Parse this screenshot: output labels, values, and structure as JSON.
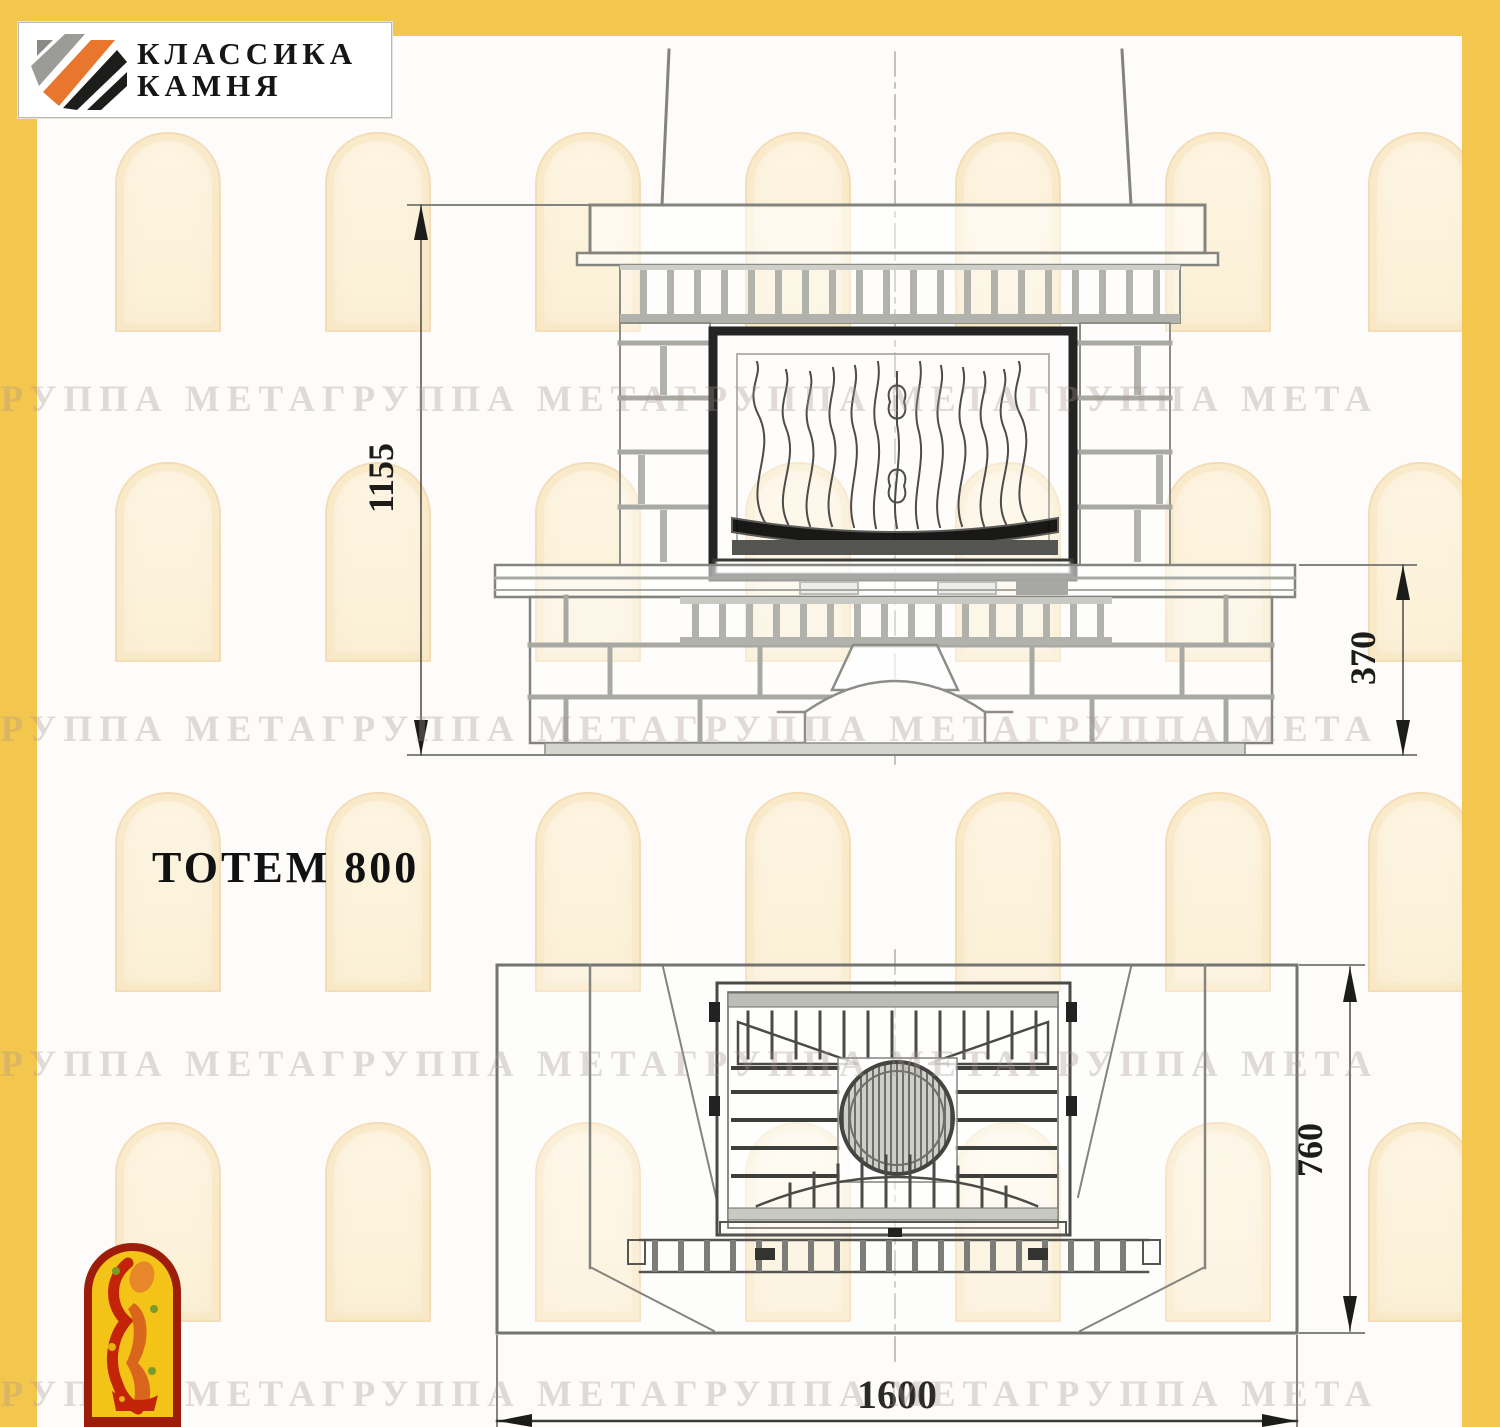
{
  "logo": {
    "line1": "КЛАССИКА",
    "line2": "КАМНЯ"
  },
  "title": "ТОТЕМ 800",
  "watermark": {
    "row_text": "ГРУППА МЕТАГРУППА МЕТАГРУППА МЕТАГРУППА МЕТА"
  },
  "drawing": {
    "front_view": {
      "height_label": "1155",
      "plinth_height_label": "370"
    },
    "plan_view": {
      "width_label": "1600",
      "depth_label": "760"
    }
  },
  "colors": {
    "frame_yellow": "#f3c64e",
    "line_gray": "#888884",
    "line_dark": "#222222",
    "emblem_red": "#9e1d0a",
    "emblem_yellow": "#f4c318",
    "logo_orange": "#e8762c"
  }
}
